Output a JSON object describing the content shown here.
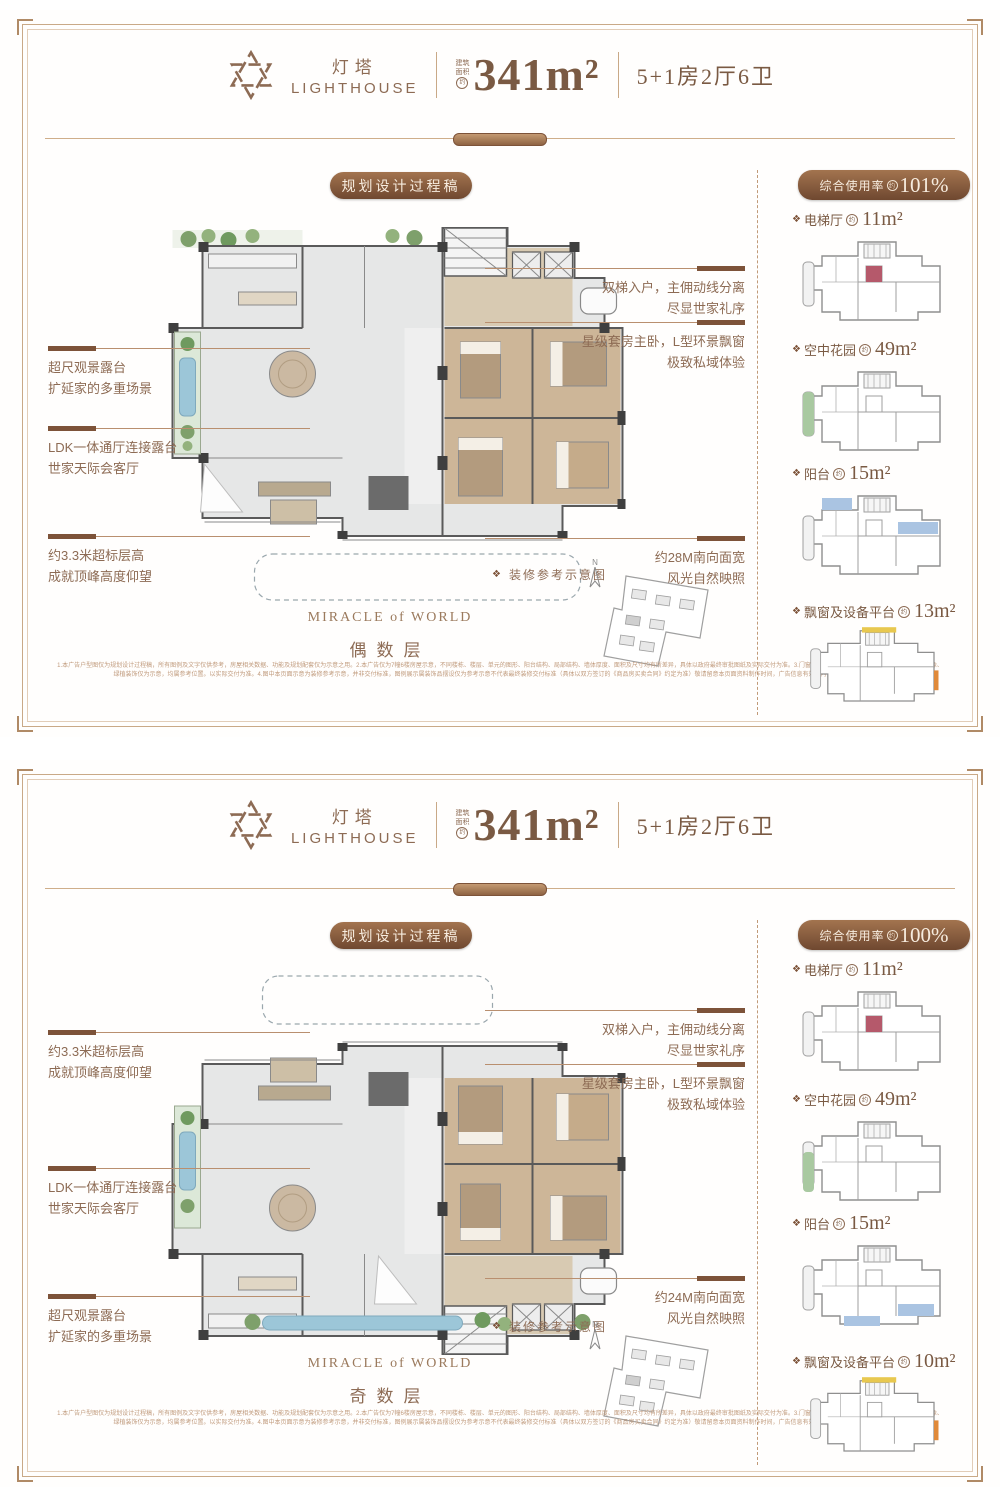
{
  "brand": {
    "name_cn": "灯塔",
    "name_en": "LIGHTHOUSE"
  },
  "header": {
    "area_prefix_1": "建筑",
    "area_prefix_2": "面积",
    "approx": "约",
    "area_value": "341m²",
    "layout": "5+1房2厅6卫"
  },
  "process_badge": "规划设计过程稿",
  "decor_note": "装修参考示意图",
  "compass_n": "N",
  "slogan": "MIRACLE of WORLD",
  "colors": {
    "accent_brown": "#8d6b54",
    "badge_dark": "#6f4830",
    "frame": "#c9a987"
  },
  "panels": [
    {
      "floor_label": "偶数层",
      "usage": {
        "label": "综合使用率",
        "approx": "约",
        "value": "101%"
      },
      "sidebar_items": [
        {
          "label": "电梯厅",
          "approx": "约",
          "value": "11m²",
          "highlight_colors": [
            "#b5596b",
            "#b5596b"
          ]
        },
        {
          "label": "空中花园",
          "approx": "约",
          "value": "49m²",
          "highlight_colors": [
            "#a9c9a1",
            "#a9c9a1"
          ]
        },
        {
          "label": "阳台",
          "approx": "约",
          "value": "15m²",
          "highlight_colors": [
            "#aac4e2",
            "#aac4e2"
          ]
        },
        {
          "label": "飘窗及设备平台",
          "approx": "约",
          "value": "13m²",
          "highlight_colors": [
            "#e8c84f",
            "#e08a3a"
          ]
        }
      ],
      "annotations_left": [
        {
          "line1": "超尺观景露台",
          "line2": "扩延家的多重场景"
        },
        {
          "line1": "LDK一体通厅连接露台",
          "line2": "世家天际会客厅"
        },
        {
          "line1": "约3.3米超标层高",
          "line2": "成就顶峰高度仰望"
        }
      ],
      "annotations_right": [
        {
          "line1": "双梯入户，主佣动线分离",
          "line2": "尽显世家礼序"
        },
        {
          "line1": "星级套房主卧，L型环景飘窗",
          "line2": "极致私域体验"
        },
        {
          "line1": "约28M南向面宽",
          "line2": "风光自然映照"
        }
      ],
      "disclaimer1": "1.本广告户型图仅为规划设计过程稿，所有图例及文字仅供参考，房屋相关数据、功能及规划配套仅为示意之用。2.本广告仅为7幢6楼房屋示意，不同楼栋、楼层、单元的图形、阳台结构、局部结构、墙体厚度、面积及尺寸均有所差异，具体以政府最终审批图纸及实际交付为准。3.门窗位置、开启方式及开启方向、图中所示家具摆像、",
      "disclaimer2": "绿植装饰仅为示意，均属参考位置。以实际交付为准。4.图中本页面示意为装修参考示意，并非交付标准，图例展示属装饰品摆设仅为参考示意不代表最终装修交付标准（具体以双方签订的《商品房买卖合同》约定为准）敬请留意本页面资料制作时间，广告信息有效期内，不尽所示敬请谅解。"
    },
    {
      "floor_label": "奇数层",
      "usage": {
        "label": "综合使用率",
        "approx": "约",
        "value": "100%"
      },
      "sidebar_items": [
        {
          "label": "电梯厅",
          "approx": "约",
          "value": "11m²",
          "highlight_colors": [
            "#b5596b",
            "#b5596b"
          ]
        },
        {
          "label": "空中花园",
          "approx": "约",
          "value": "49m²",
          "highlight_colors": [
            "#a9c9a1",
            "#a9c9a1"
          ]
        },
        {
          "label": "阳台",
          "approx": "约",
          "value": "15m²",
          "highlight_colors": [
            "#aac4e2",
            "#aac4e2"
          ]
        },
        {
          "label": "飘窗及设备平台",
          "approx": "约",
          "value": "10m²",
          "highlight_colors": [
            "#e8c84f",
            "#e08a3a"
          ]
        }
      ],
      "annotations_left": [
        {
          "line1": "约3.3米超标层高",
          "line2": "成就顶峰高度仰望"
        },
        {
          "line1": "LDK一体通厅连接露台",
          "line2": "世家天际会客厅"
        },
        {
          "line1": "超尺观景露台",
          "line2": "扩延家的多重场景"
        }
      ],
      "annotations_right": [
        {
          "line1": "双梯入户，主佣动线分离",
          "line2": "尽显世家礼序"
        },
        {
          "line1": "星级套房主卧，L型环景飘窗",
          "line2": "极致私域体验"
        },
        {
          "line1": "约24M南向面宽",
          "line2": "风光自然映照"
        }
      ],
      "disclaimer1": "1.本广告户型图仅为规划设计过程稿，所有图例及文字仅供参考，房屋相关数据、功能及规划配套仅为示意之用。2.本广告仅为7幢6楼房屋示意，不同楼栋、楼层、单元的图形、阳台结构、局部结构、墙体厚度、面积及尺寸均有所差异，具体以政府最终审批图纸及实际交付为准。3.门窗位置、开启方式及开启方向、图中所示家具摆像、",
      "disclaimer2": "绿植装饰仅为示意，均属参考位置。以实际交付为准。4.图中本页面示意为装修参考示意，并非交付标准，图例展示属装饰品摆设仅为参考示意不代表最终装修交付标准（具体以双方签订的《商品房买卖合同》约定为准）敬请留意本页面资料制作时间，广告信息有效期内，不尽所示敬请谅解。"
    }
  ]
}
